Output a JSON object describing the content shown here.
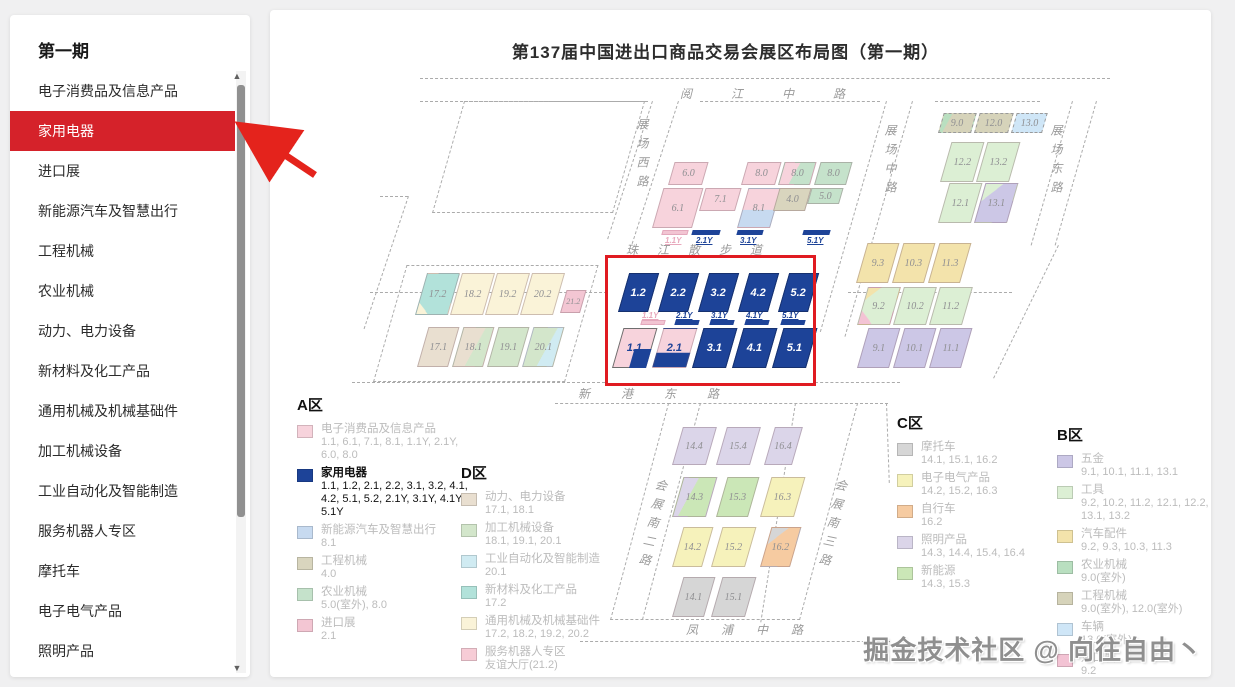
{
  "sidebar": {
    "title": "第一期",
    "items": [
      {
        "label": "电子消费品及信息产品",
        "active": false
      },
      {
        "label": "家用电器",
        "active": true
      },
      {
        "label": "进口展",
        "active": false
      },
      {
        "label": "新能源汽车及智慧出行",
        "active": false
      },
      {
        "label": "工程机械",
        "active": false
      },
      {
        "label": "农业机械",
        "active": false
      },
      {
        "label": "动力、电力设备",
        "active": false
      },
      {
        "label": "新材料及化工产品",
        "active": false
      },
      {
        "label": "通用机械及机械基础件",
        "active": false
      },
      {
        "label": "加工机械设备",
        "active": false
      },
      {
        "label": "工业自动化及智能制造",
        "active": false
      },
      {
        "label": "服务机器人专区",
        "active": false
      },
      {
        "label": "摩托车",
        "active": false
      },
      {
        "label": "电子电气产品",
        "active": false
      },
      {
        "label": "照明产品",
        "active": false
      },
      {
        "label": "新能源",
        "active": false
      }
    ],
    "scroll_up_icon": "▲",
    "scroll_down_icon": "▼"
  },
  "map": {
    "title": "第137届中国进出口商品交易会展区布局图（第一期）",
    "roads": {
      "yuejiang": "阅 江 中 路",
      "zhanchang_xi": "展场西路",
      "zhanchang_zhong": "展场中路",
      "zhanchang_dong": "展场东路",
      "zhujiang": "珠 江 散 步 道",
      "xingang": "新 港 东 路",
      "huizhan_nan2": "会展南二路",
      "huizhan_nan3": "会展南三路",
      "fengpu": "凤 浦 中 路"
    },
    "halls": {
      "h6_0": "6.0",
      "h8_0a": "8.0",
      "h8_0b": "8.0",
      "h8_0c": "8.0",
      "h6_1": "6.1",
      "h7_1": "7.1",
      "h8_1": "8.1",
      "h4_0": "4.0",
      "h5_0": "5.0",
      "h1_2": "1.2",
      "h2_2": "2.2",
      "h3_2": "3.2",
      "h4_2": "4.2",
      "h5_2": "5.2",
      "h1_1": "1.1",
      "h2_1": "2.1",
      "h3_1": "3.1",
      "h4_1": "4.1",
      "h5_1": "5.1",
      "h17_2": "17.2",
      "h18_2": "18.2",
      "h19_2": "19.2",
      "h20_2": "20.2",
      "h21_2": "21.2",
      "h17_1": "17.1",
      "h18_1": "18.1",
      "h19_1": "19.1",
      "h20_1": "20.1",
      "h9_0": "9.0",
      "h12_0": "12.0",
      "h13_0": "13.0",
      "h12_2": "12.2",
      "h13_2": "13.2",
      "h12_1": "12.1",
      "h13_1": "13.1",
      "h9_3": "9.3",
      "h10_3": "10.3",
      "h11_3": "11.3",
      "h9_2": "9.2",
      "h10_2": "10.2",
      "h11_2": "11.2",
      "h9_1": "9.1",
      "h10_1": "10.1",
      "h11_1": "11.1",
      "h14_4": "14.4",
      "h15_4": "15.4",
      "h16_4": "16.4",
      "h14_3": "14.3",
      "h15_3": "15.3",
      "h16_3": "16.3",
      "h14_2": "14.2",
      "h15_2": "15.2",
      "h16_2": "16.2",
      "h14_1": "14.1",
      "h15_1": "15.1"
    },
    "ybars": {
      "top": [
        "1.1Y",
        "2.1Y",
        "3.1Y",
        "5.1Y"
      ],
      "box": [
        "1.1Y",
        "2.1Y",
        "3.1Y",
        "4.1Y",
        "5.1Y"
      ]
    }
  },
  "legends": {
    "a": {
      "title": "A区",
      "items": [
        {
          "name": "电子消费品及信息产品",
          "halls": "1.1, 6.1, 7.1, 8.1, 1.1Y, 2.1Y, 6.0, 8.0"
        },
        {
          "name": "家用电器",
          "halls": "1.1, 1.2, 2.1, 2.2, 3.1, 3.2, 4.1, 4.2, 5.1, 5.2, 2.1Y, 3.1Y, 4.1Y, 5.1Y"
        },
        {
          "name": "新能源汽车及智慧出行",
          "halls": "8.1"
        },
        {
          "name": "工程机械",
          "halls": "4.0"
        },
        {
          "name": "农业机械",
          "halls": "5.0(室外), 8.0"
        },
        {
          "name": "进口展",
          "halls": "2.1"
        }
      ]
    },
    "d": {
      "title": "D区",
      "items": [
        {
          "name": "动力、电力设备",
          "halls": "17.1, 18.1"
        },
        {
          "name": "加工机械设备",
          "halls": "18.1, 19.1, 20.1"
        },
        {
          "name": "工业自动化及智能制造",
          "halls": "20.1"
        },
        {
          "name": "新材料及化工产品",
          "halls": "17.2"
        },
        {
          "name": "通用机械及机械基础件",
          "halls": "17.2, 18.2, 19.2, 20.2"
        },
        {
          "name": "服务机器人专区",
          "halls": "友谊大厅(21.2)"
        }
      ]
    },
    "c": {
      "title": "C区",
      "items": [
        {
          "name": "摩托车",
          "halls": "14.1, 15.1, 16.2"
        },
        {
          "name": "电子电气产品",
          "halls": "14.2, 15.2, 16.3"
        },
        {
          "name": "自行车",
          "halls": "16.2"
        },
        {
          "name": "照明产品",
          "halls": "14.3, 14.4, 15.4, 16.4"
        },
        {
          "name": "新能源",
          "halls": "14.3, 15.3"
        }
      ]
    },
    "b": {
      "title": "B区",
      "items": [
        {
          "name": "五金",
          "halls": "9.1, 10.1, 11.1, 13.1"
        },
        {
          "name": "工具",
          "halls": "9.2, 10.2, 11.2, 12.1, 12.2, 13.1, 13.2"
        },
        {
          "name": "汽车配件",
          "halls": "9.2, 9.3, 10.3, 11.3"
        },
        {
          "name": "农业机械",
          "halls": "9.0(室外)"
        },
        {
          "name": "工程机械",
          "halls": "9.0(室外), 12.0(室外)"
        },
        {
          "name": "车辆",
          "halls": "13.0(室外)"
        },
        {
          "name": "进口展",
          "halls": "9.2"
        }
      ]
    }
  },
  "colors": {
    "accent_red": "#d5222a",
    "highlight_box_red": "#e01b21",
    "hall_navy": "#1d4398",
    "pink": "#f7d3dc",
    "import_pink": "#f3c6d3",
    "light_blue": "#c7daf0",
    "tan": "#d9d5be",
    "green": "#c5e2cb",
    "cream": "#faf3d8",
    "teal": "#b2e2da",
    "cyan": "#d0ebf2",
    "d_tan": "#e9dfd0",
    "d_green": "#d3e6cb",
    "c_gray": "#d6d6d6",
    "c_yellow": "#f6f2bb",
    "c_orange": "#f6cba1",
    "c_lavender": "#dbd5e9",
    "c_green": "#cbe7b7",
    "b_lavender": "#ccc7e6",
    "b_green": "#dcefd4",
    "b_yellow": "#f3e3ab",
    "b_darkgreen": "#b9dfc0",
    "b_tan": "#d6d3ba",
    "b_blue": "#cfe6f7",
    "b_pink": "#f3c3d4"
  },
  "watermark": "掘金技术社区 @ 向往自由丶"
}
